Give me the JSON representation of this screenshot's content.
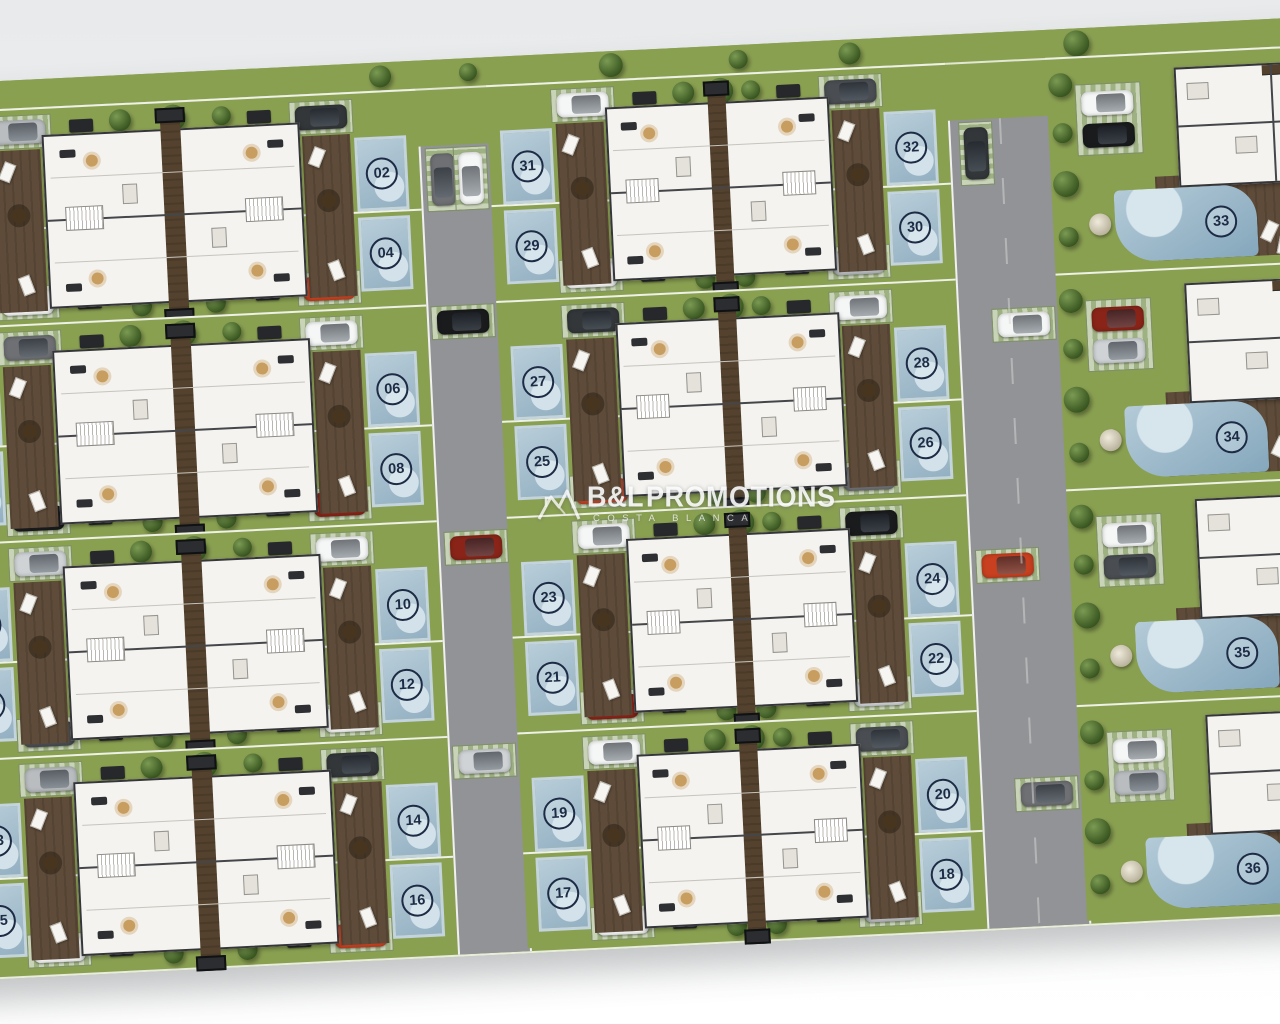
{
  "watermark": {
    "logo_icon": "roofline-mountains-logo",
    "brand": "B&L",
    "name": "PROMOTIONS",
    "subtitle": "COSTA BLANCA"
  },
  "site_plan": {
    "description": "Top-down site plan of a 36-plot residential development with semi-detached houses, private pools, roads and parked cars",
    "total_plots": 36,
    "left_column_blocks": [
      {
        "plots": [
          "01",
          "02",
          "03",
          "04"
        ]
      },
      {
        "plots": [
          "05",
          "06",
          "07",
          "08"
        ]
      },
      {
        "plots": [
          "09",
          "10",
          "11",
          "12"
        ]
      },
      {
        "plots": [
          "13",
          "14",
          "15",
          "16"
        ]
      }
    ],
    "middle_column_blocks": [
      {
        "plots": [
          "31",
          "32",
          "29",
          "30"
        ]
      },
      {
        "plots": [
          "27",
          "28",
          "25",
          "26"
        ]
      },
      {
        "plots": [
          "23",
          "24",
          "21",
          "22"
        ]
      },
      {
        "plots": [
          "19",
          "20",
          "17",
          "18"
        ]
      }
    ],
    "villa_plots": [
      "33",
      "34",
      "35",
      "36"
    ]
  },
  "colors": {
    "background": "#eef0f1",
    "lawn": "#8aa051",
    "terrace": "#5e4b39",
    "road": "#919396",
    "pool": "#a9c2d3",
    "badge": "#1d2b45",
    "house": "#f4f3ef",
    "car_palette": [
      "#f5f6f6",
      "#b9bdc0",
      "#33373a",
      "#f5f6f6",
      "#c8401f",
      "#6e7074",
      "#f5f6f6",
      "#1a1b1d",
      "#8a2418",
      "#cfd3d5",
      "#f5f6f6",
      "#4a4e52"
    ]
  }
}
